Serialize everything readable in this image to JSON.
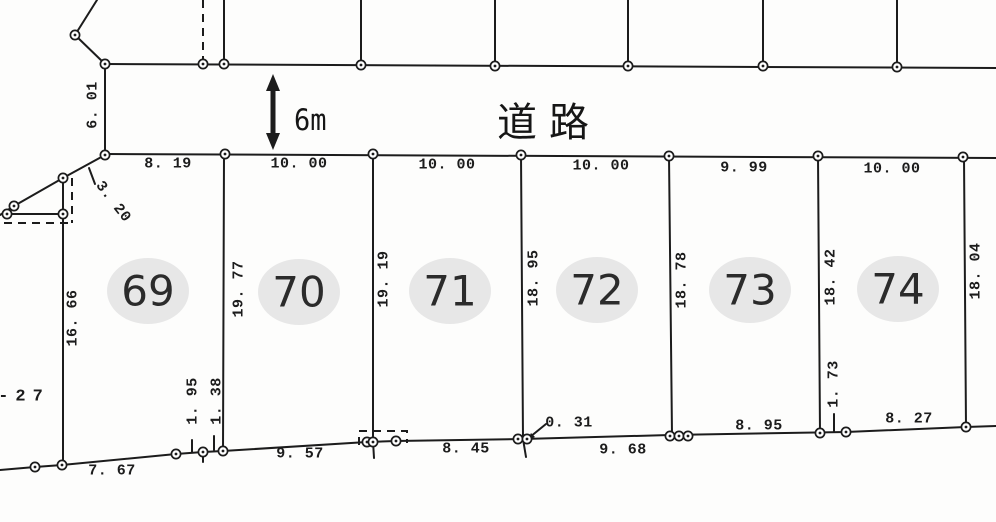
{
  "road": {
    "label": "道路",
    "width_label": "6m"
  },
  "plots": [
    {
      "number": "69",
      "cx": 148,
      "cy": 291
    },
    {
      "number": "70",
      "cx": 299,
      "cy": 292
    },
    {
      "number": "71",
      "cx": 450,
      "cy": 291
    },
    {
      "number": "72",
      "cx": 597,
      "cy": 290
    },
    {
      "number": "73",
      "cx": 750,
      "cy": 290
    },
    {
      "number": "74",
      "cx": 898,
      "cy": 289
    }
  ],
  "dimension_labels": [
    {
      "text": "8. 19",
      "x": 168,
      "y": 164,
      "rot": 0
    },
    {
      "text": "10. 00",
      "x": 299,
      "y": 164,
      "rot": 0
    },
    {
      "text": "10. 00",
      "x": 447,
      "y": 165,
      "rot": 0
    },
    {
      "text": "10. 00",
      "x": 601,
      "y": 166,
      "rot": 0
    },
    {
      "text": "9. 99",
      "x": 744,
      "y": 168,
      "rot": 0
    },
    {
      "text": "10. 00",
      "x": 892,
      "y": 169,
      "rot": 0
    },
    {
      "text": "6. 01",
      "x": 93,
      "y": 105,
      "rot": -90
    },
    {
      "text": "3. 20",
      "x": 113,
      "y": 202,
      "rot": 52
    },
    {
      "text": "16. 66",
      "x": 73,
      "y": 318,
      "rot": -90
    },
    {
      "text": "19. 77",
      "x": 239,
      "y": 289,
      "rot": -90
    },
    {
      "text": "19. 19",
      "x": 384,
      "y": 279,
      "rot": -90
    },
    {
      "text": "18. 95",
      "x": 534,
      "y": 278,
      "rot": -90
    },
    {
      "text": "18. 78",
      "x": 682,
      "y": 280,
      "rot": -90
    },
    {
      "text": "18. 42",
      "x": 831,
      "y": 277,
      "rot": -90
    },
    {
      "text": "18. 04",
      "x": 976,
      "y": 271,
      "rot": -90
    },
    {
      "text": "1. 95",
      "x": 193,
      "y": 401,
      "rot": -90
    },
    {
      "text": "1. 38",
      "x": 217,
      "y": 401,
      "rot": -90
    },
    {
      "text": "1. 73",
      "x": 834,
      "y": 384,
      "rot": -90
    },
    {
      "text": "-27",
      "x": 24,
      "y": 397,
      "rot": 0,
      "size": 17,
      "ls": 7
    },
    {
      "text": "7. 67",
      "x": 112,
      "y": 471,
      "rot": 0
    },
    {
      "text": "9. 57",
      "x": 300,
      "y": 454,
      "rot": 0
    },
    {
      "text": "8. 45",
      "x": 466,
      "y": 449,
      "rot": 0
    },
    {
      "text": "0. 31",
      "x": 569,
      "y": 423,
      "rot": 0
    },
    {
      "text": "9. 68",
      "x": 623,
      "y": 450,
      "rot": 0
    },
    {
      "text": "8. 95",
      "x": 759,
      "y": 426,
      "rot": 0
    },
    {
      "text": "8. 27",
      "x": 909,
      "y": 419,
      "rot": 0
    }
  ],
  "geometry": {
    "solid_polylines": [
      [
        [
          105,
          64
        ],
        [
          996,
          68
        ]
      ],
      [
        [
          105,
          154
        ],
        [
          996,
          158
        ]
      ],
      [
        [
          105,
          64
        ],
        [
          105,
          155
        ]
      ],
      [
        [
          75,
          35
        ],
        [
          105,
          64
        ]
      ],
      [
        [
          75,
          35
        ],
        [
          97,
          0
        ]
      ],
      [
        [
          224,
          0
        ],
        [
          224,
          64
        ]
      ],
      [
        [
          361,
          0
        ],
        [
          361,
          65
        ]
      ],
      [
        [
          495,
          0
        ],
        [
          495,
          66
        ]
      ],
      [
        [
          628,
          0
        ],
        [
          628,
          66
        ]
      ],
      [
        [
          763,
          0
        ],
        [
          763,
          66
        ]
      ],
      [
        [
          897,
          0
        ],
        [
          897,
          67
        ]
      ],
      [
        [
          105,
          155
        ],
        [
          63,
          178
        ],
        [
          14,
          206
        ],
        [
          0,
          215
        ]
      ],
      [
        [
          63,
          178
        ],
        [
          63,
          214
        ]
      ],
      [
        [
          7,
          214
        ],
        [
          63,
          214
        ]
      ],
      [
        [
          63,
          214
        ],
        [
          63,
          465
        ]
      ],
      [
        [
          89,
          168
        ],
        [
          95,
          184
        ]
      ],
      [
        [
          224,
          154
        ],
        [
          223,
          451
        ]
      ],
      [
        [
          373,
          154
        ],
        [
          373,
          441
        ]
      ],
      [
        [
          373,
          441
        ],
        [
          374,
          458
        ]
      ],
      [
        [
          521,
          155
        ],
        [
          523,
          439
        ]
      ],
      [
        [
          523,
          439
        ],
        [
          526,
          457
        ]
      ],
      [
        [
          669,
          156
        ],
        [
          672,
          435
        ]
      ],
      [
        [
          818,
          156
        ],
        [
          820,
          433
        ]
      ],
      [
        [
          964,
          157
        ],
        [
          966,
          427
        ]
      ],
      [
        [
          0,
          470
        ],
        [
          35,
          467
        ],
        [
          62,
          465
        ],
        [
          176,
          454
        ],
        [
          203,
          452
        ],
        [
          223,
          451
        ],
        [
          367,
          442
        ],
        [
          396,
          441
        ],
        [
          523,
          439
        ],
        [
          670,
          435
        ],
        [
          846,
          432
        ],
        [
          966,
          427
        ],
        [
          996,
          426
        ]
      ],
      [
        [
          192,
          440
        ],
        [
          192,
          452
        ]
      ],
      [
        [
          214,
          436
        ],
        [
          214,
          450
        ]
      ],
      [
        [
          203,
          452
        ],
        [
          203,
          462
        ]
      ],
      [
        [
          834,
          414
        ],
        [
          834,
          432
        ]
      ],
      [
        [
          546,
          424
        ],
        [
          530,
          437
        ]
      ]
    ],
    "thick_lines": [
      [
        [
          273,
          84
        ],
        [
          273,
          140
        ]
      ]
    ],
    "dashed_polylines": [
      [
        [
          203,
          0
        ],
        [
          203,
          64
        ]
      ],
      [
        [
          72,
          178
        ],
        [
          72,
          223
        ]
      ],
      [
        [
          4,
          223
        ],
        [
          72,
          223
        ]
      ],
      [
        [
          359,
          445
        ],
        [
          359,
          431
        ],
        [
          407,
          431
        ],
        [
          407,
          443
        ]
      ]
    ],
    "polygons": [
      [
        [
          273,
          74
        ],
        [
          266,
          91
        ],
        [
          280,
          91
        ]
      ],
      [
        [
          273,
          150
        ],
        [
          266,
          133
        ],
        [
          280,
          133
        ]
      ],
      [
        [
          527,
          441
        ],
        [
          535,
          437
        ],
        [
          531,
          433
        ]
      ]
    ],
    "survey_points": [
      [
        75,
        35
      ],
      [
        105,
        64
      ],
      [
        203,
        64
      ],
      [
        224,
        64
      ],
      [
        361,
        65
      ],
      [
        495,
        66
      ],
      [
        628,
        66
      ],
      [
        763,
        66
      ],
      [
        897,
        67
      ],
      [
        105,
        155
      ],
      [
        225,
        154
      ],
      [
        373,
        154
      ],
      [
        521,
        155
      ],
      [
        669,
        156
      ],
      [
        818,
        156
      ],
      [
        963,
        157
      ],
      [
        63,
        178
      ],
      [
        14,
        206
      ],
      [
        7,
        214
      ],
      [
        63,
        214
      ],
      [
        35,
        467
      ],
      [
        62,
        465
      ],
      [
        176,
        454
      ],
      [
        203,
        452
      ],
      [
        223,
        451
      ],
      [
        367,
        442
      ],
      [
        373,
        442
      ],
      [
        396,
        441
      ],
      [
        518,
        439
      ],
      [
        527,
        439
      ],
      [
        670,
        436
      ],
      [
        679,
        436
      ],
      [
        688,
        436
      ],
      [
        820,
        433
      ],
      [
        846,
        432
      ],
      [
        966,
        427
      ]
    ]
  },
  "colors": {
    "background": "#fdfdfc",
    "ink": "#1c1c1c",
    "plot_circle_fill": "#e7e7e7",
    "plot_number_color": "#2b2b2b"
  }
}
